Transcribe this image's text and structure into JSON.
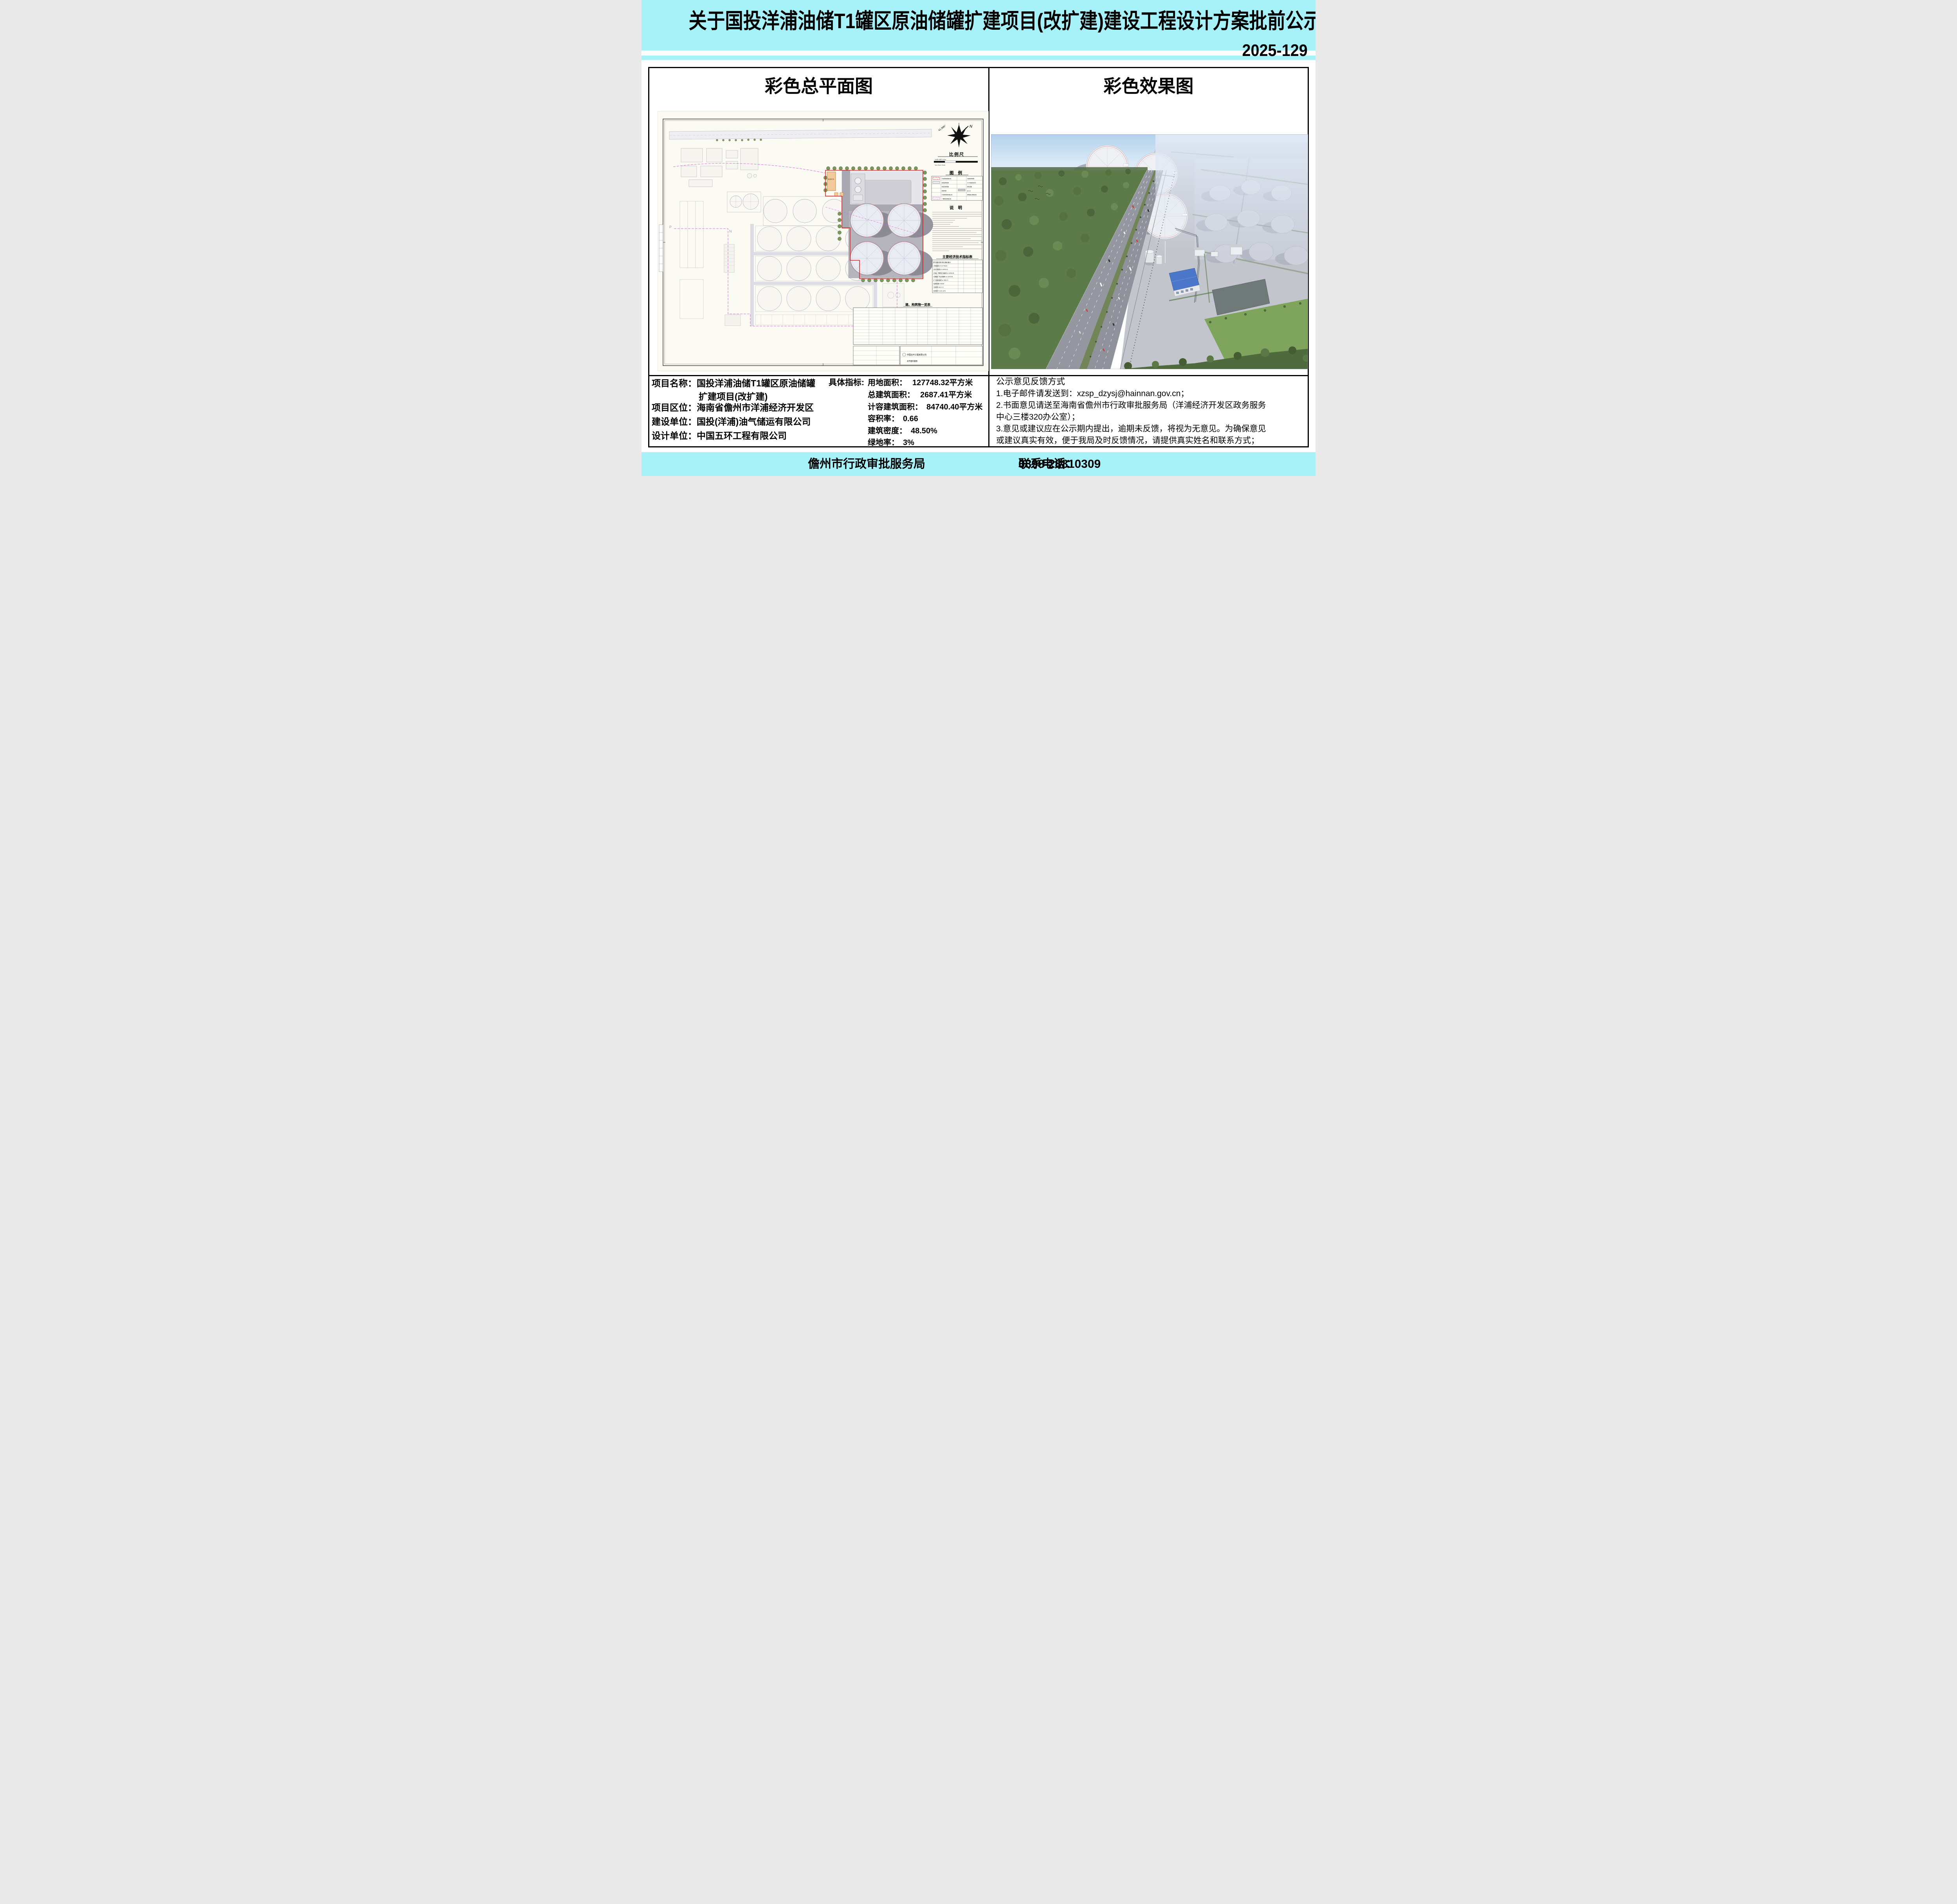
{
  "banner": {
    "title": "关于国投洋浦油储T1罐区原油储罐扩建项目(改扩建)建设工程设计方案批前公示牌",
    "notice_number": "2025-129",
    "background_color": "#a7f1f8"
  },
  "panels": {
    "left_header": "彩色总平面图",
    "right_header": "彩色效果图"
  },
  "site_plan": {
    "north_label": "N",
    "north_angle": "41.995°",
    "scale_title": "比例尺",
    "scale_ticks_top": "10米            50米            100m",
    "scale_ticks_bottom": "1cm             5cm             10cm",
    "legend_title": "图  例",
    "legend_items": [
      "扩建项目用地红线",
      "新建建构筑物",
      "新建实体围墙",
      "新建管廊",
      "扩建项目建筑退让线",
      "一期项目用地红线",
      "已建建构筑物",
      "±0.00处绝对标高",
      "新建道路",
      "出入口",
      "控规退让用地红线"
    ],
    "notes_title": "说  明",
    "indicator_table_title": "主要经济技术指标表",
    "indicator_header": "序号  指标名称  单位  数量  备注",
    "indicator_rows": [
      "1  用地面积  m²  127748.32",
      "2  总计容面积  m²  84740.40",
      "3  总建、构筑物占地面积  m²  61964.05",
      "4  道路及广场占地面积  m²  21310.36",
      "5  厂区绿化面积  m²  3832.71",
      "6  建筑系数  %  48.50",
      "7  容积率  0.66  >0.3",
      "8  绿地率  %  3.00  ≤15%"
    ],
    "building_list_title": "建、构筑物一览表",
    "warehouse_label": "备品备件库",
    "corner_label_p": "P",
    "corner_label_n": "N",
    "titleblock_company": "中国五环工程有限公司",
    "titleblock_drawing": "总平面布置图",
    "boundary_color_new": "#e01818",
    "boundary_color_phase1": "#d66ad6"
  },
  "info": {
    "fields": [
      {
        "label": "项目名称",
        "colon": "：",
        "value": "国投洋浦油储T1罐区原油储罐",
        "value2": "扩建项目(改扩建)"
      },
      {
        "label": "项目区位",
        "colon": "：",
        "value": "海南省儋州市洋浦经济开发区"
      },
      {
        "label": "建设单位",
        "colon": "：",
        "value": "国投(洋浦)油气储运有限公司"
      },
      {
        "label": "设计单位",
        "colon": "：",
        "value": "中国五环工程有限公司"
      }
    ],
    "metrics_label": "具体指标:",
    "metrics": [
      {
        "name": "用地面积：",
        "value": "127748.32平方米"
      },
      {
        "name": "总建筑面积：",
        "value": "2687.41平方米"
      },
      {
        "name": "计容建筑面积：",
        "value": "84740.40平方米"
      },
      {
        "name": "容积率：",
        "value": "0.66"
      },
      {
        "name": "建筑密度：",
        "value": "48.50%"
      },
      {
        "name": "绿地率：",
        "value": "3%"
      }
    ]
  },
  "feedback": {
    "title": "公示意见反馈方式",
    "lines": [
      "1.电子邮件请发送到：xzsp_dzysj@hainnan.gov.cn；",
      "2.书面意见请送至海南省儋州市行政审批服务局（洋浦经济开发区政务服务",
      "中心三楼320办公室）；",
      "3.意见或建议应在公示期内提出，逾期未反馈，将视为无意见。为确保意见",
      "或建议真实有效，便于我局及时反馈情况，请提供真实姓名和联系方式；"
    ]
  },
  "footer": {
    "agency": "儋州市行政审批服务局",
    "phone_label": "联系电话：",
    "phone_number": "0898-28810309"
  }
}
